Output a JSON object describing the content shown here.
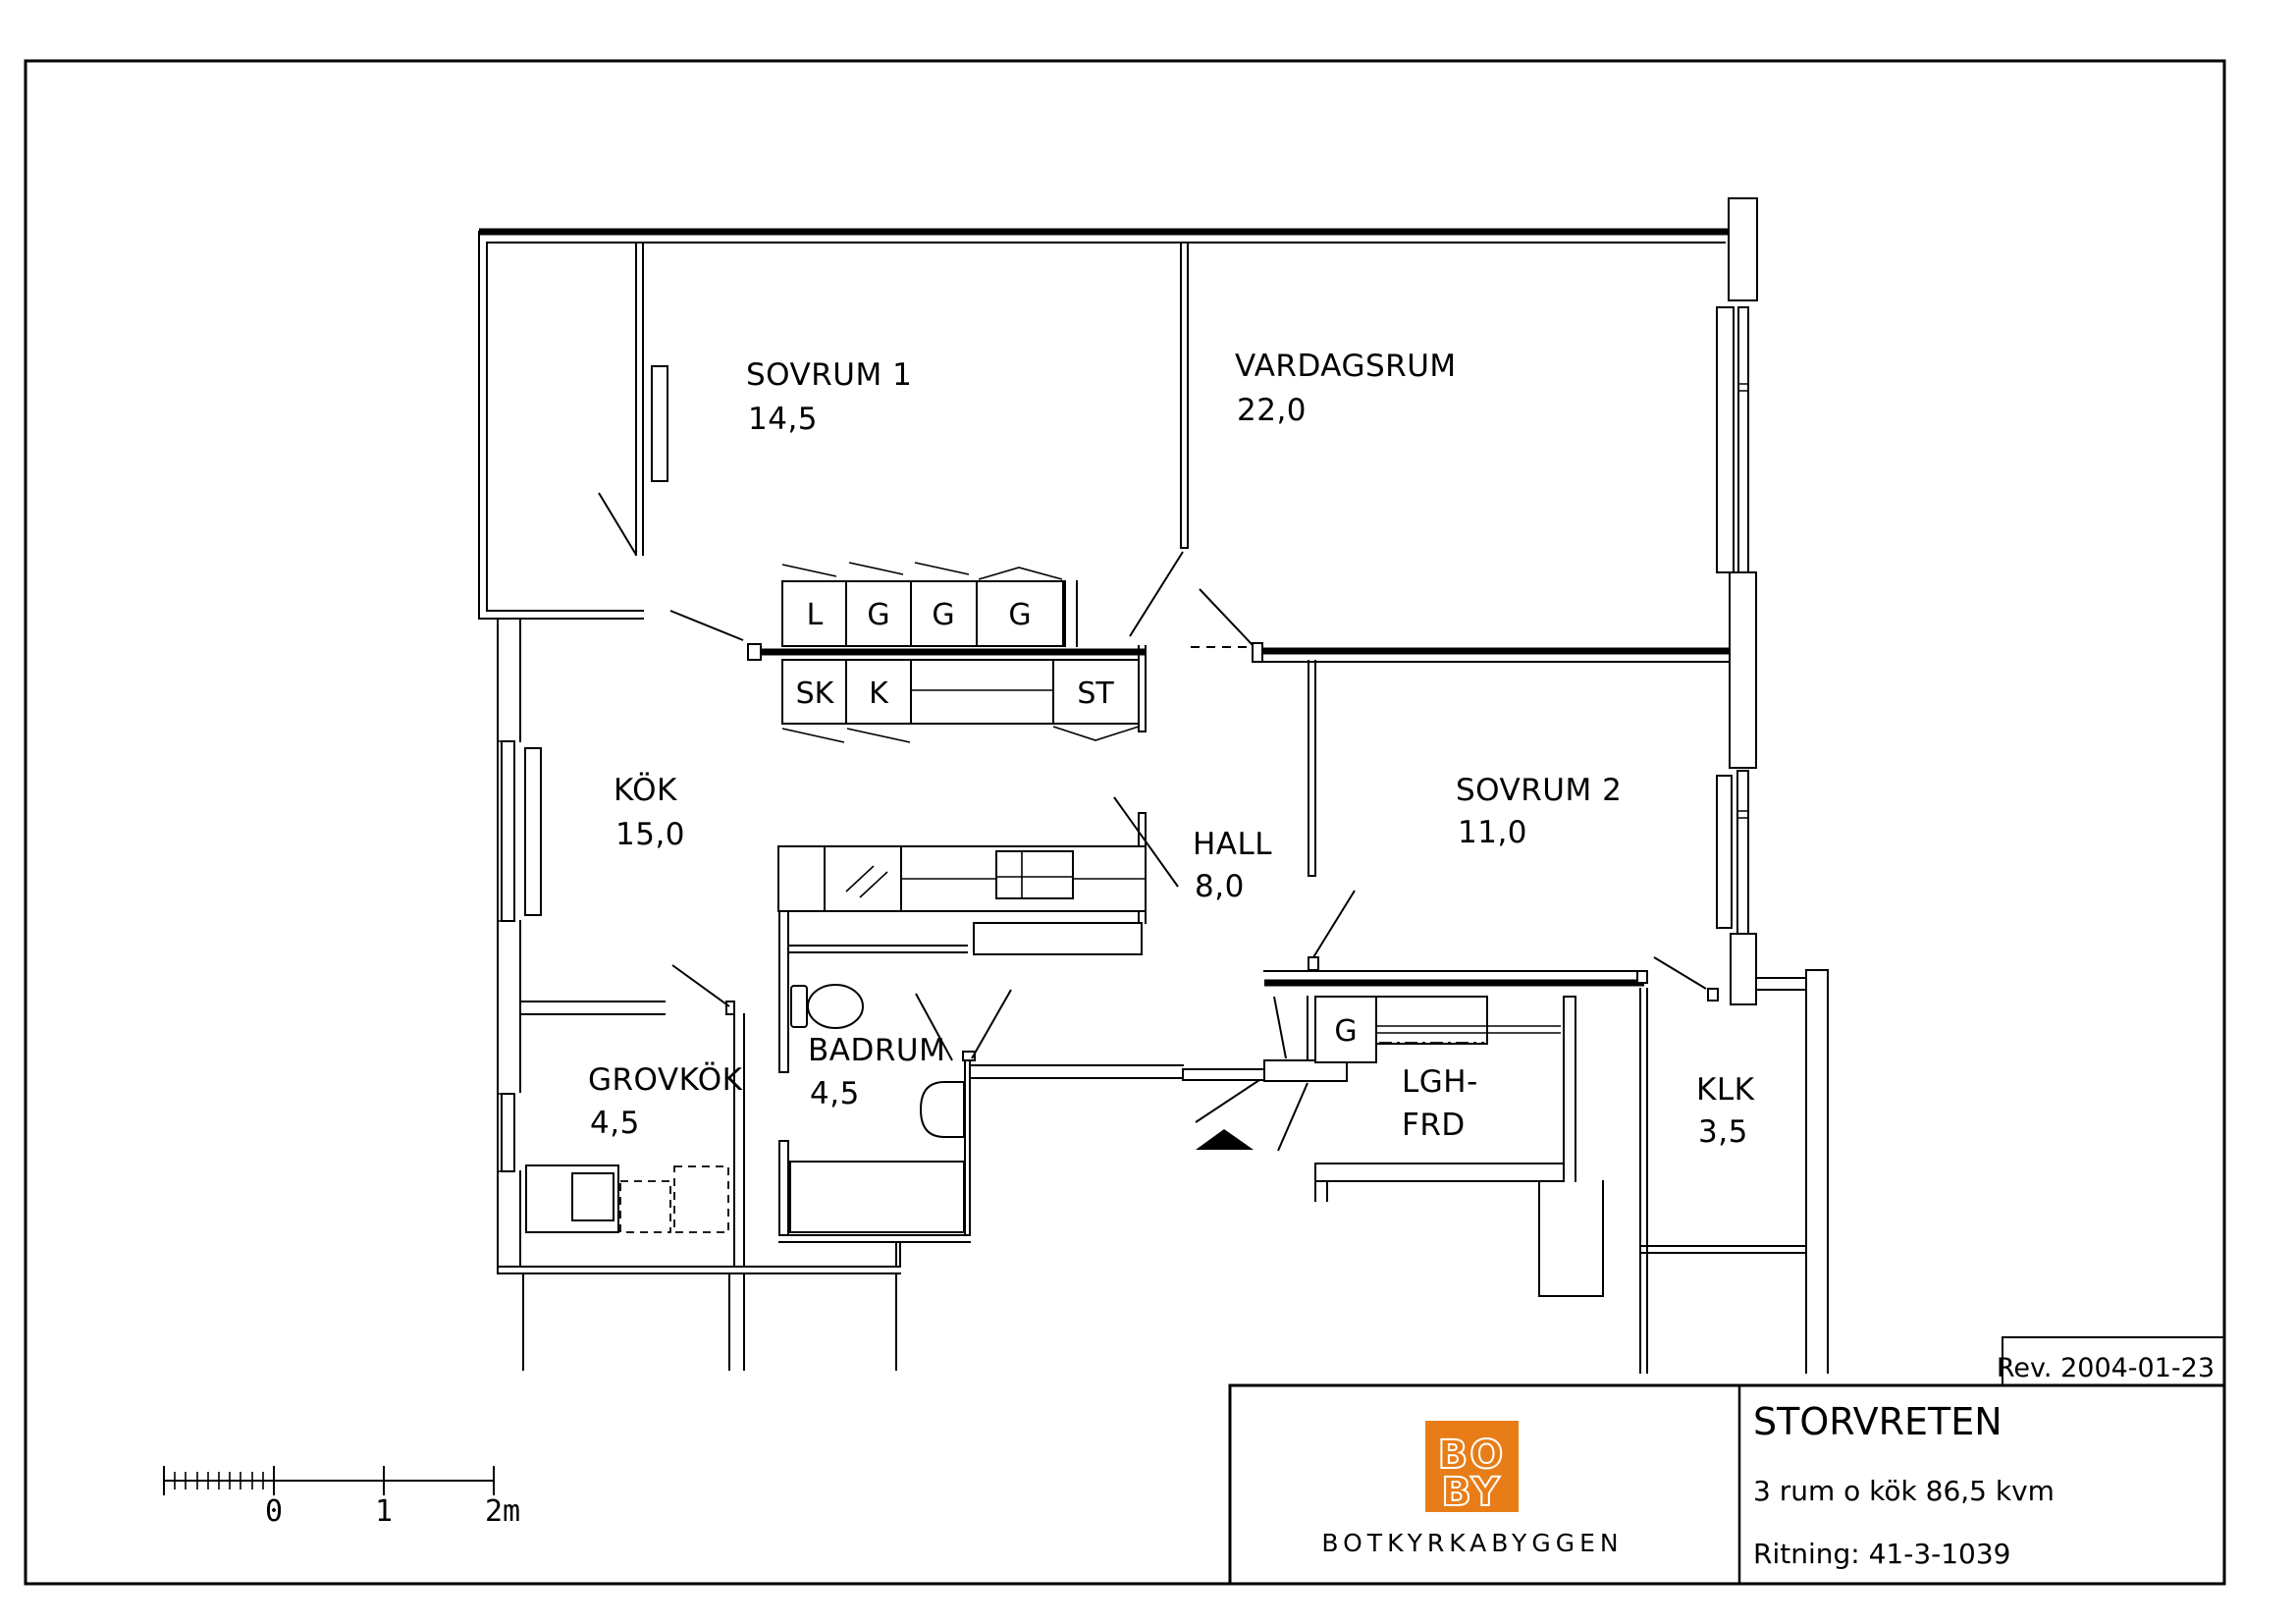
{
  "page": {
    "rev": "Rev. 2004-01-23"
  },
  "title_block": {
    "project": "STORVRETEN",
    "description": "3 rum o kök 86,5 kvm",
    "drawing_number": "Ritning: 41-3-1039",
    "company": "BOTKYRKABYGGEN",
    "logo_line1": "BO",
    "logo_line2": "BY",
    "logo_color": "#E87D17"
  },
  "scale_bar": {
    "labels": [
      "0",
      "1",
      "2m"
    ]
  },
  "plan": {
    "rooms": [
      {
        "name": "SOVRUM 1",
        "area": "14,5"
      },
      {
        "name": "VARDAGSRUM",
        "area": "22,0"
      },
      {
        "name": "KÖK",
        "area": "15,0"
      },
      {
        "name": "SOVRUM 2",
        "area": "11,0"
      },
      {
        "name": "HALL",
        "area": "8,0"
      },
      {
        "name": "BADRUM",
        "area": "4,5"
      },
      {
        "name": "GROVKÖK",
        "area": "4,5"
      },
      {
        "name": "KLK",
        "area": "3,5"
      }
    ],
    "storage": {
      "line1": "LGH-",
      "line2": "FRD"
    },
    "cabinets": {
      "linen": "L",
      "g1": "G",
      "g2": "G",
      "g3": "G",
      "sk": "SK",
      "k": "K",
      "st": "ST",
      "hall_g": "G"
    }
  }
}
